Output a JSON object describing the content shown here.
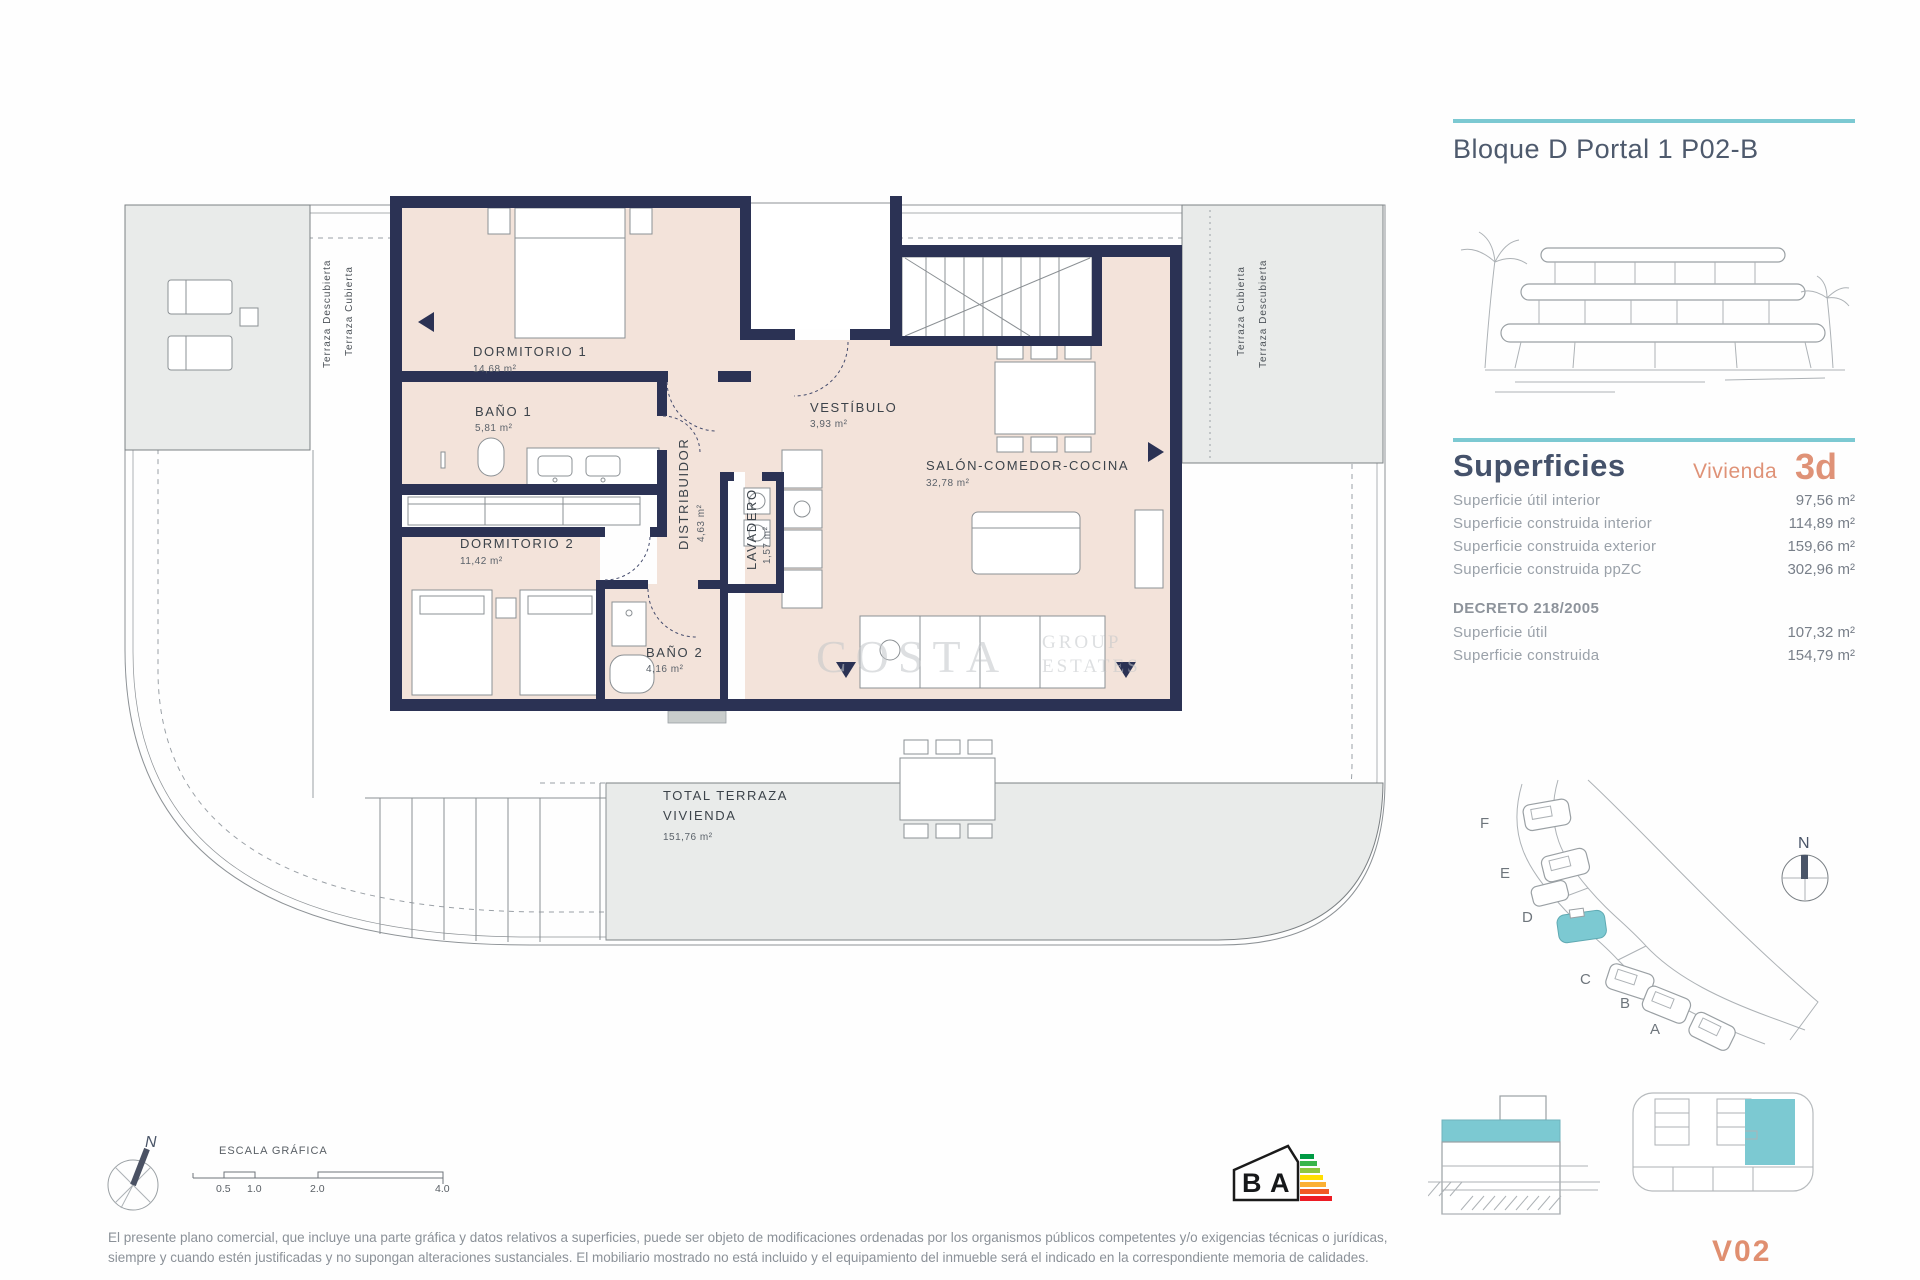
{
  "header": {
    "title": "Bloque D Portal 1 P02-B"
  },
  "superficies": {
    "title": "Superficies",
    "vivienda_label": "Vivienda",
    "vivienda_code": "3d",
    "rows": [
      {
        "label": "Superficie útil interior",
        "value": "97,56 m²"
      },
      {
        "label": "Superficie construida interior",
        "value": "114,89 m²"
      },
      {
        "label": "Superficie construida exterior",
        "value": "159,66 m²"
      },
      {
        "label": "Superficie construida ppZC",
        "value": "302,96 m²"
      }
    ],
    "decreto_title": "DECRETO 218/2005",
    "decreto_rows": [
      {
        "label": "Superficie útil",
        "value": "107,32 m²"
      },
      {
        "label": "Superficie construida",
        "value": "154,79 m²"
      }
    ]
  },
  "plan": {
    "rooms": {
      "dormitorio1": {
        "name": "DORMITORIO 1",
        "area": "14,68 m²"
      },
      "bano1": {
        "name": "BAÑO 1",
        "area": "5,81 m²"
      },
      "distribuidor": {
        "name": "DISTRIBUIDOR",
        "area": "4,63 m²"
      },
      "vestibulo": {
        "name": "VESTÍBULO",
        "area": "3,93 m²"
      },
      "salon": {
        "name": "SALÓN-COMEDOR-COCINA",
        "area": "32,78 m²"
      },
      "dormitorio2": {
        "name": "DORMITORIO 2",
        "area": "11,42 m²"
      },
      "lavadero": {
        "name": "LAVADERO",
        "area": "1,57 m²"
      },
      "bano2": {
        "name": "BAÑO 2",
        "area": "4,16 m²"
      },
      "terraza": {
        "name_line1": "TOTAL TERRAZA",
        "name_line2": "VIVIENDA",
        "area": "151,76 m²"
      }
    },
    "terrace_labels": {
      "left_outer": "Terraza Descubierta",
      "left_inner": "Terraza Cubierta",
      "right_inner": "Terraza Cubierta",
      "right_outer": "Terraza Descubierta"
    },
    "watermark": {
      "big": "COSTA",
      "small1": "GROUP",
      "small2": "ESTATES"
    }
  },
  "site_plan": {
    "blocks": [
      "F",
      "E",
      "D",
      "C",
      "B",
      "A"
    ],
    "north": "N"
  },
  "compass": {
    "north": "N"
  },
  "scale_bar": {
    "title": "ESCALA GRÁFICA",
    "ticks": [
      "0.5",
      "1.0",
      "2.0",
      "4.0"
    ]
  },
  "energy": {
    "b": "B",
    "a": "A"
  },
  "footer": {
    "unit_code": "V02",
    "disclaimer": "El presente plano comercial, que incluye una parte gráfica y datos relativos a superficies, puede ser objeto de modificaciones ordenadas por los organismos públicos competentes y/o exigencias técnicas o jurídicas, siempre y cuando estén justificadas y no supongan alteraciones sustanciales. El mobiliario mostrado no está incluido y el equipamiento del inmueble será el indicado en la correspondiente memoria de calidades."
  },
  "colors": {
    "accent_teal": "#7cc9d2",
    "accent_orange": "#df9277",
    "wall_navy": "#2b3254",
    "room_fill": "#f3e3da",
    "terrace_fill": "#e9ebea"
  }
}
